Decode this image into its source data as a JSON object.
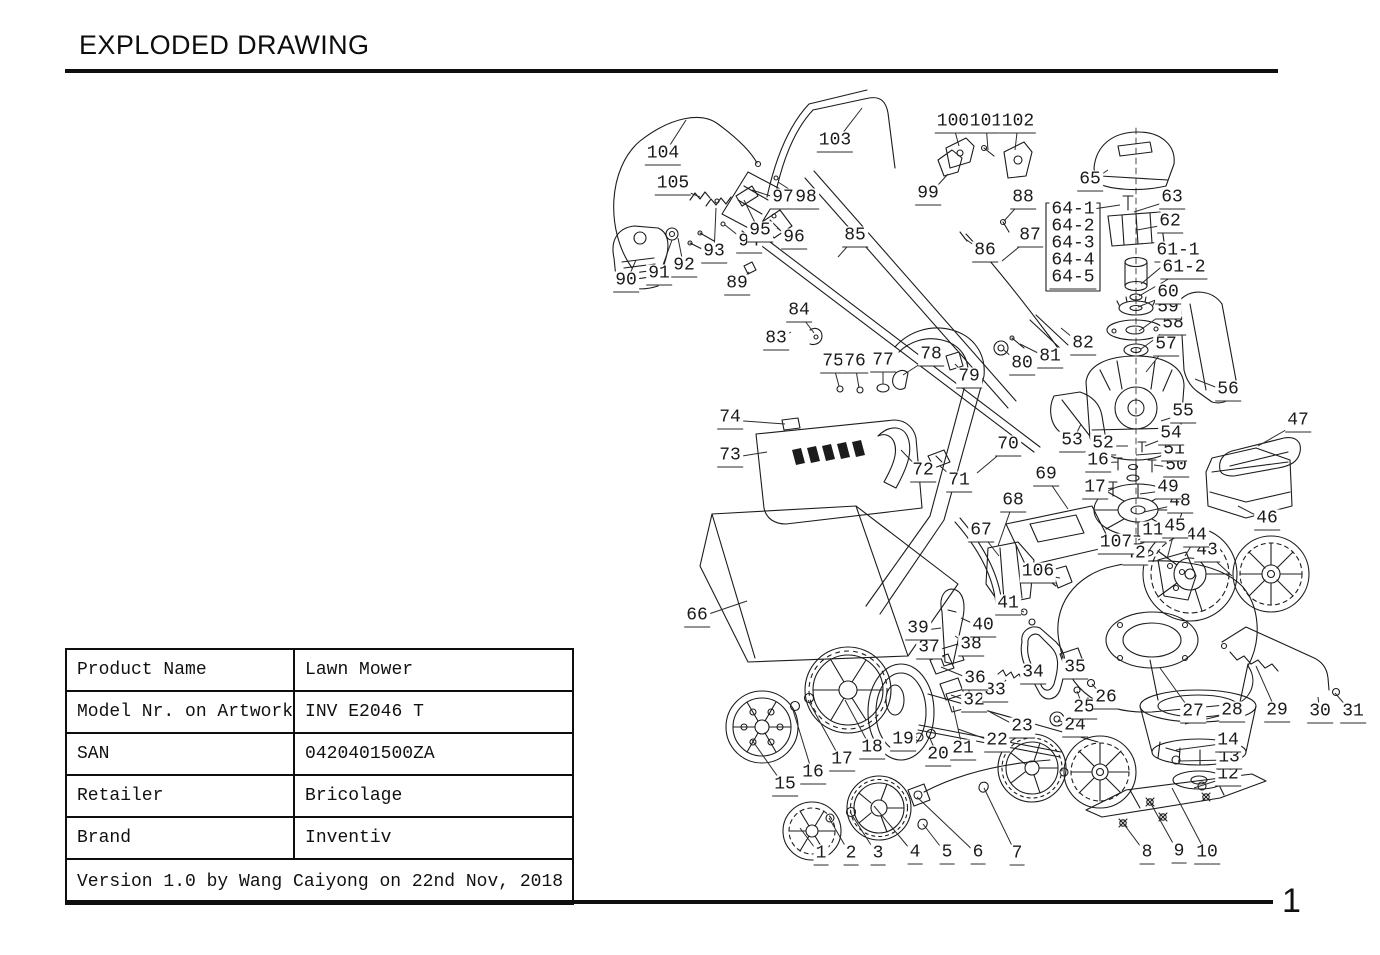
{
  "page": {
    "title": "EXPLODED DRAWING",
    "page_number": "1"
  },
  "table": {
    "rows": [
      {
        "label": "Product Name",
        "value": "Lawn Mower"
      },
      {
        "label": "Model Nr. on Artwork",
        "value": "INV E2046 T"
      },
      {
        "label": "SAN",
        "value": "0420401500ZA"
      },
      {
        "label": "Retailer",
        "value": "Bricolage"
      },
      {
        "label": "Brand",
        "value": "Inventiv"
      }
    ],
    "footer": "Version 1.0 by Wang Caiyong on 22nd Nov, 2018"
  },
  "diagram": {
    "description": "Exploded view drawing of a lawn mower with numbered part callouts",
    "parts": [
      {
        "n": "1",
        "x": 821,
        "y": 856,
        "tx": 800,
        "ty": 828
      },
      {
        "n": "2",
        "x": 851,
        "y": 856,
        "tx": 829,
        "ty": 818
      },
      {
        "n": "3",
        "x": 878,
        "y": 856,
        "tx": 850,
        "ty": 812
      },
      {
        "n": "4",
        "x": 915,
        "y": 855,
        "tx": 874,
        "ty": 806
      },
      {
        "n": "5",
        "x": 947,
        "y": 855,
        "tx": 923,
        "ty": 824
      },
      {
        "n": "6",
        "x": 978,
        "y": 855,
        "tx": 917,
        "ty": 797
      },
      {
        "n": "7",
        "x": 1017,
        "y": 856,
        "tx": 984,
        "ty": 788
      },
      {
        "n": "8",
        "x": 1147,
        "y": 855,
        "tx": 1123,
        "ty": 823
      },
      {
        "n": "9",
        "x": 1179,
        "y": 854,
        "tx": 1150,
        "ty": 802
      },
      {
        "n": "10",
        "x": 1207,
        "y": 855,
        "tx": 1172,
        "ty": 788
      },
      {
        "n": "11",
        "x": 1153,
        "y": 533,
        "tx": 1138,
        "ty": 540
      },
      {
        "n": "12",
        "x": 1228,
        "y": 777,
        "tx": 1194,
        "ty": 788
      },
      {
        "n": "13",
        "x": 1229,
        "y": 760,
        "tx": 1178,
        "ty": 761
      },
      {
        "n": "14",
        "x": 1228,
        "y": 743,
        "tx": 1176,
        "ty": 750
      },
      {
        "n": "15",
        "x": 785,
        "y": 787,
        "tx": 752,
        "ty": 740
      },
      {
        "n": "16",
        "x": 813,
        "y": 775,
        "tx": 793,
        "ty": 710
      },
      {
        "n": "17",
        "x": 842,
        "y": 762,
        "tx": 808,
        "ty": 700
      },
      {
        "n": "18",
        "x": 872,
        "y": 750,
        "tx": 845,
        "ty": 700
      },
      {
        "n": "19",
        "x": 903,
        "y": 742,
        "tx": 917,
        "ty": 737
      },
      {
        "n": "20",
        "x": 938,
        "y": 757,
        "tx": 929,
        "ty": 736
      },
      {
        "n": "21",
        "x": 963,
        "y": 751,
        "tx": 953,
        "ty": 706
      },
      {
        "n": "22",
        "x": 997,
        "y": 743,
        "tx": 958,
        "ty": 729
      },
      {
        "n": "23",
        "x": 1022,
        "y": 729,
        "tx": 990,
        "ty": 712
      },
      {
        "n": "24",
        "x": 1075,
        "y": 728,
        "tx": 1058,
        "ty": 720
      },
      {
        "n": "25",
        "x": 1084,
        "y": 710,
        "tx": 1077,
        "ty": 691
      },
      {
        "n": "26",
        "x": 1106,
        "y": 700,
        "tx": 1092,
        "ty": 684
      },
      {
        "n": "27",
        "x": 1193,
        "y": 714,
        "tx": 1160,
        "ty": 668
      },
      {
        "n": "28",
        "x": 1232,
        "y": 713,
        "tx": 1185,
        "ty": 724
      },
      {
        "n": "29",
        "x": 1277,
        "y": 713,
        "tx": 1256,
        "ty": 666
      },
      {
        "n": "30",
        "x": 1320,
        "y": 714,
        "tx": 1318,
        "ty": 697
      },
      {
        "n": "31",
        "x": 1353,
        "y": 714,
        "tx": 1335,
        "ty": 693
      },
      {
        "n": "32",
        "x": 974,
        "y": 703,
        "tx": 951,
        "ty": 695
      },
      {
        "n": "33",
        "x": 995,
        "y": 693,
        "tx": 1006,
        "ty": 680
      },
      {
        "n": "34",
        "x": 1033,
        "y": 675,
        "tx": 1043,
        "ty": 666
      },
      {
        "n": "35",
        "x": 1075,
        "y": 670,
        "tx": 1069,
        "ty": 659
      },
      {
        "n": "36",
        "x": 975,
        "y": 681,
        "tx": 941,
        "ty": 667
      },
      {
        "n": "37",
        "x": 929,
        "y": 650,
        "tx": 944,
        "ty": 657
      },
      {
        "n": "38",
        "x": 971,
        "y": 647,
        "tx": 955,
        "ty": 636
      },
      {
        "n": "39",
        "x": 918,
        "y": 631,
        "tx": 941,
        "ty": 628
      },
      {
        "n": "40",
        "x": 983,
        "y": 628,
        "tx": 961,
        "ty": 618
      },
      {
        "n": "41",
        "x": 1008,
        "y": 606,
        "tx": 1024,
        "ty": 612
      },
      {
        "n": "42",
        "x": 1135,
        "y": 556,
        "tx": 1147,
        "ty": 553
      },
      {
        "n": "43",
        "x": 1207,
        "y": 553,
        "tx": 1232,
        "ty": 576
      },
      {
        "n": "44",
        "x": 1196,
        "y": 538,
        "tx": 1185,
        "ty": 556
      },
      {
        "n": "45",
        "x": 1175,
        "y": 529,
        "tx": 1167,
        "ty": 559
      },
      {
        "n": "46",
        "x": 1267,
        "y": 521,
        "tx": 1238,
        "ty": 506
      },
      {
        "n": "47",
        "x": 1298,
        "y": 423,
        "tx": 1258,
        "ty": 446
      },
      {
        "n": "48",
        "x": 1180,
        "y": 504,
        "tx": 1144,
        "ty": 512
      },
      {
        "n": "49",
        "x": 1168,
        "y": 490,
        "tx": 1140,
        "ty": 494
      },
      {
        "n": "50",
        "x": 1176,
        "y": 468,
        "tx": 1154,
        "ty": 465
      },
      {
        "n": "51",
        "x": 1174,
        "y": 452,
        "tx": 1136,
        "ty": 455
      },
      {
        "n": "52",
        "x": 1103,
        "y": 446,
        "tx": 1128,
        "ty": 446
      },
      {
        "n": "53",
        "x": 1072,
        "y": 443,
        "tx": 1081,
        "ty": 424
      },
      {
        "n": "54",
        "x": 1171,
        "y": 436,
        "tx": 1145,
        "ty": 446
      },
      {
        "n": "55",
        "x": 1183,
        "y": 414,
        "tx": 1161,
        "ty": 421
      },
      {
        "n": "56",
        "x": 1228,
        "y": 392,
        "tx": 1195,
        "ty": 379
      },
      {
        "n": "57",
        "x": 1166,
        "y": 347,
        "tx": 1146,
        "ty": 372
      },
      {
        "n": "58",
        "x": 1173,
        "y": 326,
        "tx": 1141,
        "ty": 349
      },
      {
        "n": "59",
        "x": 1168,
        "y": 310,
        "tx": 1139,
        "ty": 331
      },
      {
        "n": "60",
        "x": 1168,
        "y": 295,
        "tx": 1138,
        "ty": 307
      },
      {
        "n": "61-1",
        "x": 1178,
        "y": 253,
        "tx": 1141,
        "ty": 284
      },
      {
        "n": "61-2",
        "x": 1184,
        "y": 270,
        "tx": 1139,
        "ty": 296
      },
      {
        "n": "62",
        "x": 1170,
        "y": 224,
        "tx": 1137,
        "ty": 230
      },
      {
        "n": "63",
        "x": 1172,
        "y": 200,
        "tx": 1134,
        "ty": 212
      },
      {
        "n": "64-1",
        "x": 1073,
        "y": 212,
        "tx": 1120,
        "ty": 205
      },
      {
        "n": "64-2",
        "x": 1073,
        "y": 229
      },
      {
        "n": "64-3",
        "x": 1073,
        "y": 246
      },
      {
        "n": "64-4",
        "x": 1073,
        "y": 263
      },
      {
        "n": "64-5",
        "x": 1073,
        "y": 280
      },
      {
        "n": "65",
        "x": 1090,
        "y": 182,
        "tx": 1108,
        "ty": 170
      },
      {
        "n": "66",
        "x": 697,
        "y": 618,
        "tx": 747,
        "ty": 601
      },
      {
        "n": "67",
        "x": 981,
        "y": 533,
        "tx": 999,
        "ty": 556
      },
      {
        "n": "68",
        "x": 1013,
        "y": 503,
        "tx": 998,
        "ty": 546
      },
      {
        "n": "69",
        "x": 1046,
        "y": 477,
        "tx": 1068,
        "ty": 509
      },
      {
        "n": "70",
        "x": 1008,
        "y": 447,
        "tx": 977,
        "ty": 473
      },
      {
        "n": "71",
        "x": 959,
        "y": 483,
        "tx": 940,
        "ty": 466
      },
      {
        "n": "72",
        "x": 923,
        "y": 473,
        "tx": 901,
        "ty": 450
      },
      {
        "n": "73",
        "x": 730,
        "y": 458,
        "tx": 767,
        "ty": 452
      },
      {
        "n": "74",
        "x": 730,
        "y": 420,
        "tx": 785,
        "ty": 424
      },
      {
        "n": "75",
        "x": 833,
        "y": 364,
        "tx": 839,
        "ty": 386
      },
      {
        "n": "76",
        "x": 855,
        "y": 364,
        "tx": 859,
        "ty": 388
      },
      {
        "n": "77",
        "x": 883,
        "y": 363,
        "tx": 883,
        "ty": 384
      },
      {
        "n": "78",
        "x": 931,
        "y": 357,
        "tx": 903,
        "ty": 375
      },
      {
        "n": "79",
        "x": 969,
        "y": 379,
        "tx": 955,
        "ty": 364
      },
      {
        "n": "80",
        "x": 1022,
        "y": 366,
        "tx": 1004,
        "ty": 350
      },
      {
        "n": "81",
        "x": 1050,
        "y": 359,
        "tx": 1020,
        "ty": 344
      },
      {
        "n": "82",
        "x": 1083,
        "y": 346,
        "tx": 1061,
        "ty": 328
      },
      {
        "n": "83",
        "x": 776,
        "y": 341,
        "tx": 791,
        "ty": 332
      },
      {
        "n": "84",
        "x": 799,
        "y": 313,
        "tx": 814,
        "ty": 333
      },
      {
        "n": "85",
        "x": 855,
        "y": 238,
        "tx": 838,
        "ty": 257
      },
      {
        "n": "86",
        "x": 985,
        "y": 253,
        "tx": 964,
        "ty": 238
      },
      {
        "n": "87",
        "x": 1030,
        "y": 238,
        "tx": 1002,
        "ty": 261
      },
      {
        "n": "88",
        "x": 1023,
        "y": 200,
        "tx": 1004,
        "ty": 221
      },
      {
        "n": "89",
        "x": 737,
        "y": 286,
        "tx": 749,
        "ty": 272
      },
      {
        "n": "90",
        "x": 626,
        "y": 283,
        "tx": 636,
        "ty": 260
      },
      {
        "n": "91",
        "x": 659,
        "y": 276,
        "tx": 672,
        "ty": 240
      },
      {
        "n": "92",
        "x": 684,
        "y": 268,
        "tx": 678,
        "ty": 238
      },
      {
        "n": "93",
        "x": 714,
        "y": 254,
        "tx": 716,
        "ty": 208
      },
      {
        "n": "94",
        "x": 749,
        "y": 244,
        "tx": 725,
        "ty": 225
      },
      {
        "n": "95",
        "x": 760,
        "y": 233,
        "tx": 744,
        "ty": 200
      },
      {
        "n": "96",
        "x": 794,
        "y": 240,
        "tx": 777,
        "ty": 228
      },
      {
        "n": "97",
        "x": 783,
        "y": 200,
        "tx": 752,
        "ty": 190
      },
      {
        "n": "98",
        "x": 806,
        "y": 200,
        "tx": 778,
        "ty": 182
      },
      {
        "n": "99",
        "x": 928,
        "y": 196,
        "tx": 948,
        "ty": 174
      },
      {
        "n": "100",
        "x": 953,
        "y": 124,
        "tx": 959,
        "ty": 146
      },
      {
        "n": "101",
        "x": 986,
        "y": 124,
        "tx": 988,
        "ty": 150
      },
      {
        "n": "102",
        "x": 1018,
        "y": 124,
        "tx": 1015,
        "ty": 150
      },
      {
        "n": "103",
        "x": 835,
        "y": 143,
        "tx": 862,
        "ty": 108
      },
      {
        "n": "104",
        "x": 663,
        "y": 156,
        "tx": 686,
        "ty": 120
      },
      {
        "n": "105",
        "x": 673,
        "y": 186,
        "tx": 700,
        "ty": 197
      },
      {
        "n": "106",
        "x": 1038,
        "y": 574,
        "tx": 1060,
        "ty": 578
      },
      {
        "n": "107",
        "x": 1116,
        "y": 545,
        "tx": 1129,
        "ty": 550
      },
      {
        "n": "16",
        "x": 1098,
        "y": 463,
        "tx": 1118,
        "ty": 462
      },
      {
        "n": "17",
        "x": 1095,
        "y": 490,
        "tx": 1113,
        "ty": 488
      }
    ]
  }
}
